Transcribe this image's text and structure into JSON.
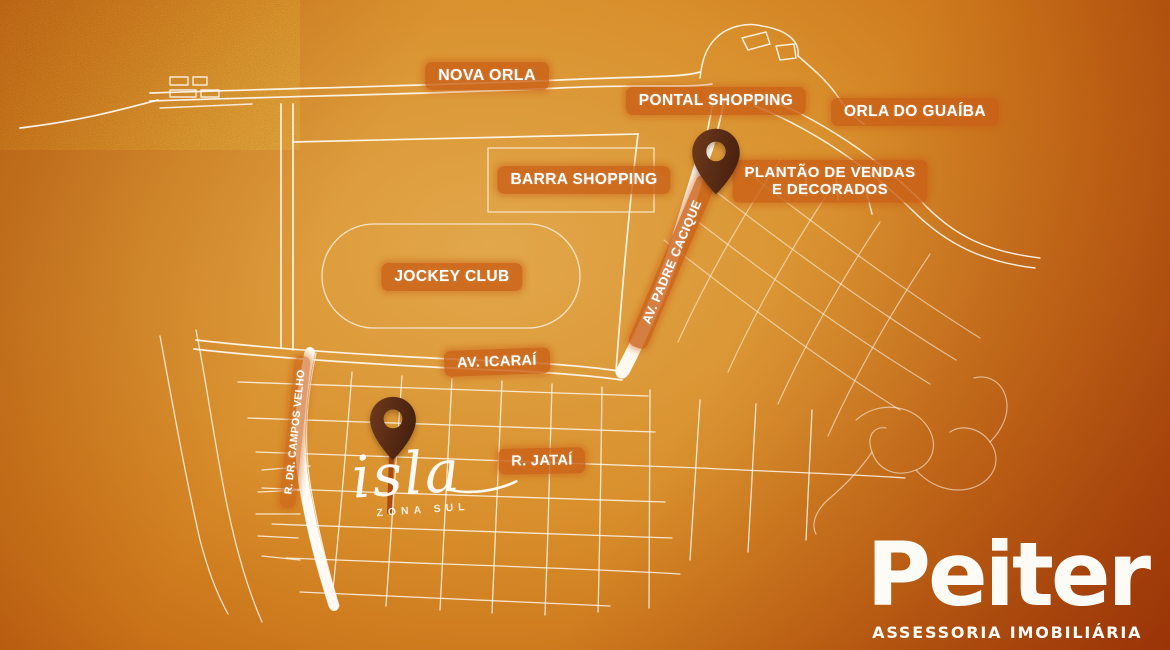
{
  "map": {
    "region_labels": {
      "nova_orla": "NOVA ORLA",
      "pontal_shopping": "PONTAL SHOPPING",
      "orla_do_guaiba": "ORLA DO GUAÍBA",
      "barra_shopping": "BARRA SHOPPING",
      "jockey_club": "JOCKEY CLUB",
      "plantao": [
        "PLANTÃO DE VENDAS",
        "E DECORADOS"
      ]
    },
    "street_labels": {
      "av_icarai": "AV. ICARAÍ",
      "av_padre_cacique": "AV. PADRE CACIQUE",
      "r_jatai": "R. JATAÍ",
      "r_dr_campos_velho": "R. DR. CAMPOS VELHO"
    },
    "pins": [
      {
        "id": "sales-office-pin"
      },
      {
        "id": "isla-site-pin"
      }
    ]
  },
  "project": {
    "name": "isla",
    "subtitle": "ZONA SUL"
  },
  "brand": {
    "name": "Peiter",
    "tagline": "ASSESSORIA IMOBILIÁRIA"
  },
  "colors": {
    "background_light": "#d8922e",
    "background_dark": "#9a3809",
    "label_pill": "#c95f16",
    "street_line": "#ffffff",
    "pin": "#5a2c14",
    "text": "#ffffff"
  }
}
